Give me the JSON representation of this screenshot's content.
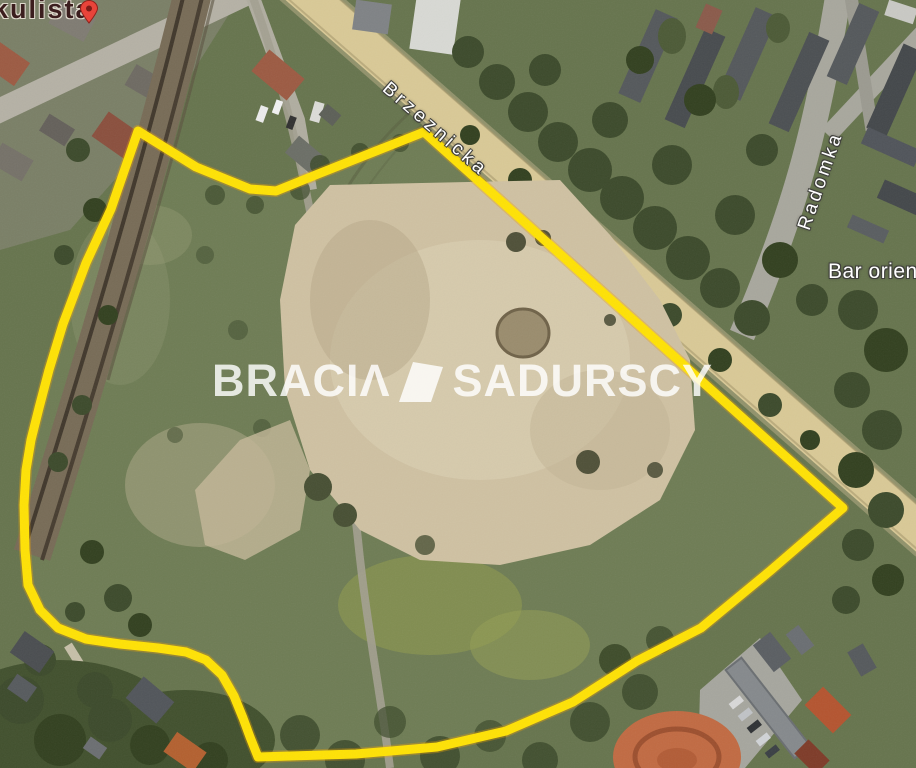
{
  "map": {
    "labels": {
      "poi_top_left": "kulista",
      "street_main": "Brzeznicka",
      "street_side": "Radomka",
      "poi_right": "Bar orien"
    },
    "watermark": {
      "brand_left": "BRACIΛ",
      "brand_right": "SADURSCY"
    },
    "colors": {
      "boundary_line": "#ffe204",
      "boundary_glow": "#eda200",
      "pin": "#e8443a",
      "road_fill": "#d9c996",
      "watermark_text": "rgba(255,255,255,0.82)"
    }
  }
}
